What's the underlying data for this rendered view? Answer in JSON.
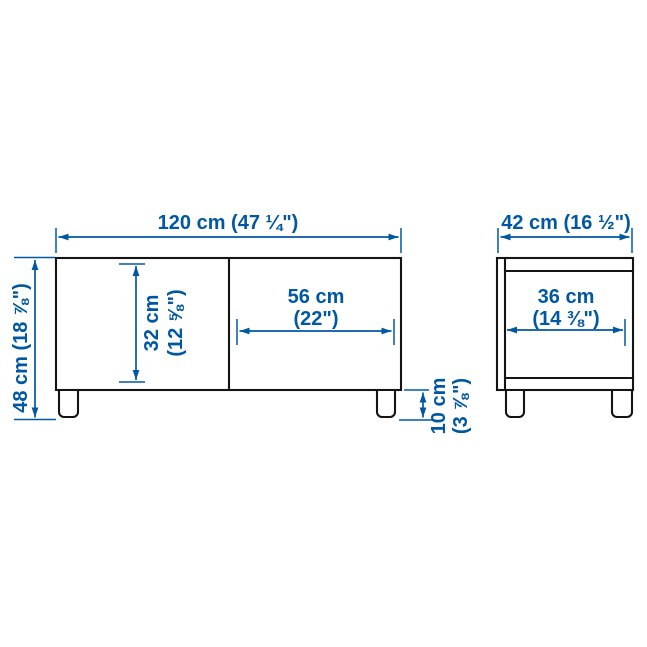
{
  "diagram": {
    "kind": "furniture-dimension-diagram",
    "subject": "TV bench with two doors and legs, front view and side view"
  },
  "colors": {
    "dimension_blue": "#0058a3",
    "outline": "#141414",
    "background": "#ffffff"
  },
  "front_view": {
    "width_label": "120 cm (47 ¼\")",
    "height_label": "48 cm (18 ⅞\")",
    "inner_height": {
      "cm": "32 cm",
      "inch": "(12 ⅝\")"
    },
    "door_width": {
      "cm": "56 cm",
      "inch": "(22\")"
    },
    "leg_height": {
      "cm": "10 cm",
      "inch": "(3 ⅞\")"
    }
  },
  "side_view": {
    "depth_label": "42 cm (16 ½\")",
    "inner_depth": {
      "cm": "36 cm",
      "inch": "(14 ⅜\")"
    }
  }
}
